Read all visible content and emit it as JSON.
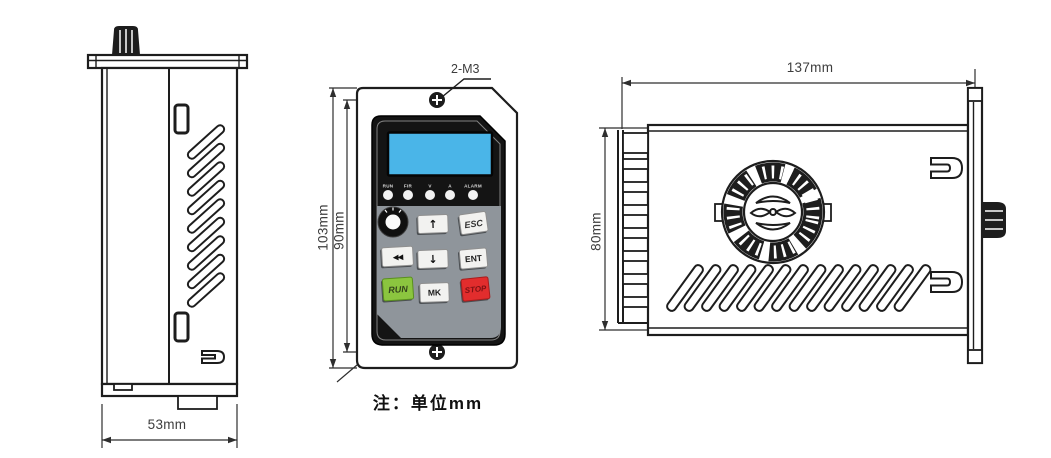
{
  "drawing": {
    "note": "注：单位mm",
    "side_view": {
      "width_dim": "53mm"
    },
    "front_view": {
      "screw_spec": "2-M3",
      "outer_height_dim": "103mm",
      "inner_height_dim": "90mm",
      "led_labels": [
        "RUN",
        "FIR",
        "V",
        "A",
        "ALARM"
      ],
      "keys": {
        "up": "↑",
        "esc": "ESC",
        "prev": "◀◀",
        "down": "↓",
        "ent": "ENT",
        "run": "RUN",
        "mk": "MK",
        "stop": "STOP"
      }
    },
    "top_view": {
      "width_dim": "137mm",
      "height_dim": "80mm"
    },
    "colors": {
      "line": "#1d1d1d",
      "lcd_blue": "#4ab5e8",
      "keypad_gray": "#8f959b",
      "run_green": "#8bc53f",
      "stop_red": "#e22d2d",
      "key_face": "#f2f2f0",
      "bezel_black": "#141414"
    }
  }
}
